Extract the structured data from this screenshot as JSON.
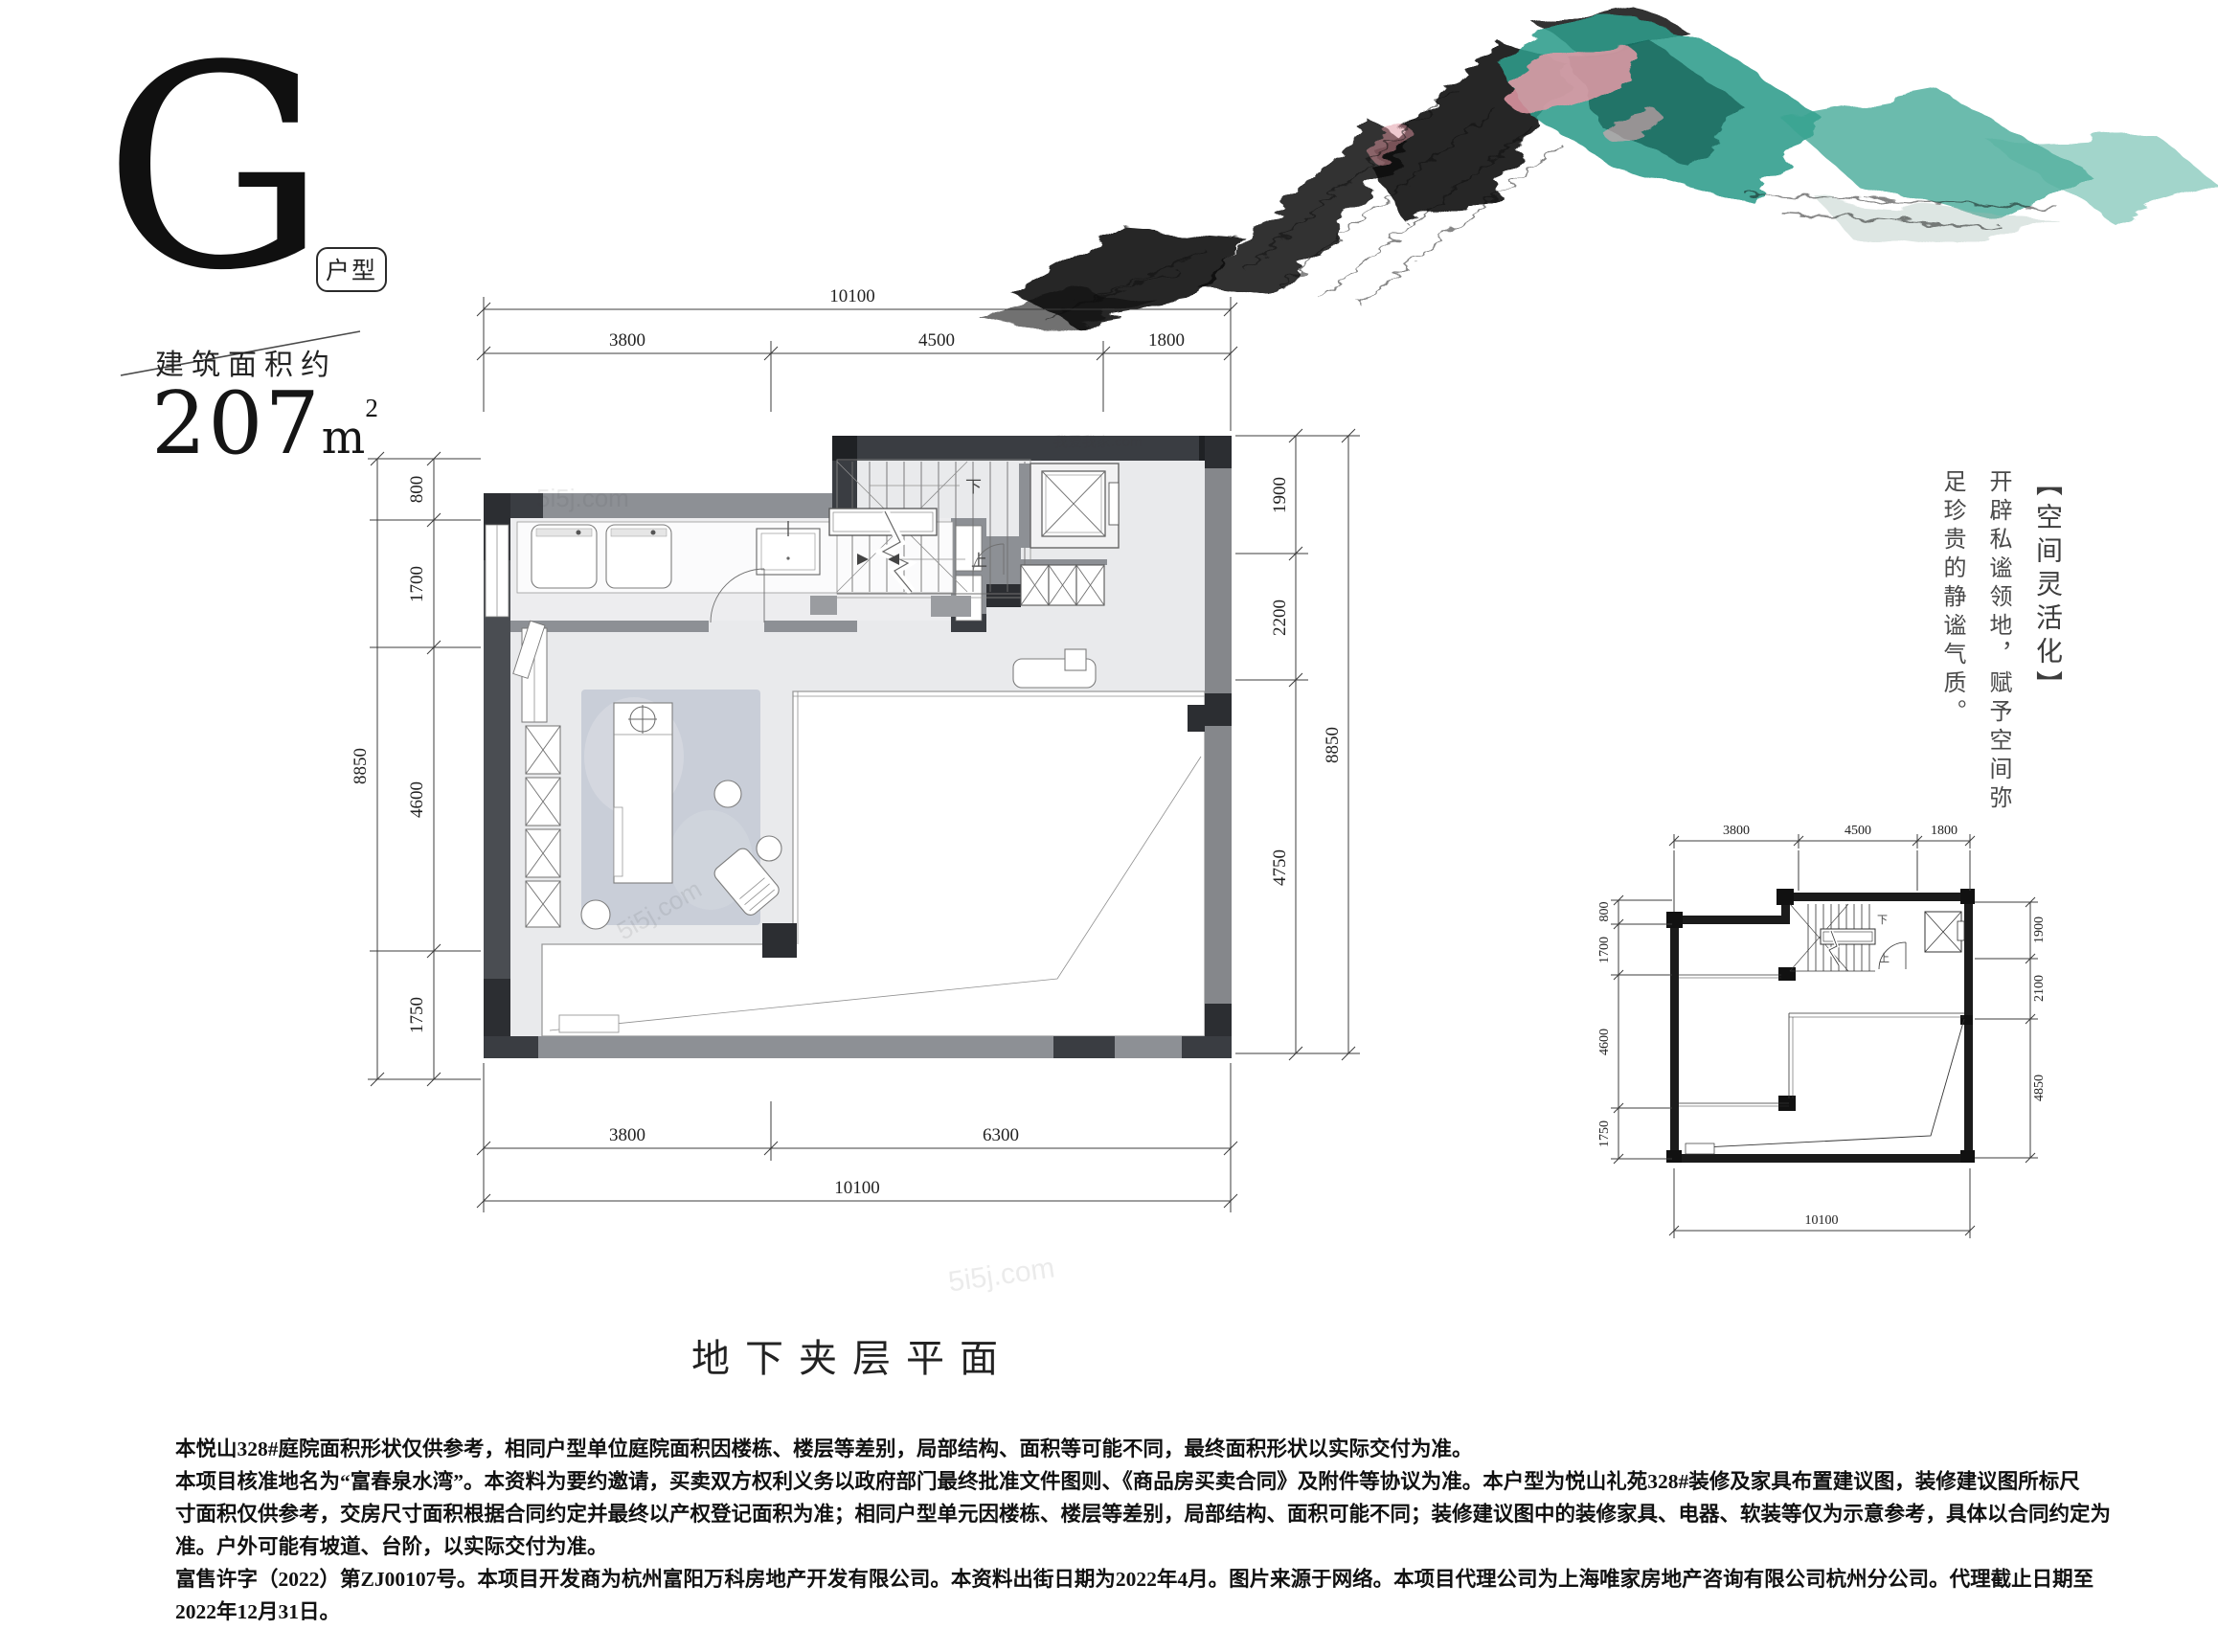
{
  "header": {
    "type_letter": "G",
    "type_badge": "户型",
    "area_label": "建筑面积约",
    "area_value": "207",
    "area_unit": "m",
    "area_sup": "2"
  },
  "main_plan": {
    "dims": {
      "top": {
        "total": "10100",
        "segments": [
          "3800",
          "4500",
          "1800"
        ]
      },
      "left": {
        "total": "8850",
        "segments": [
          "800",
          "1700",
          "4600",
          "1750"
        ]
      },
      "right": {
        "total": "8850",
        "segments": [
          "1900",
          "2200",
          "4750"
        ]
      },
      "bottom": {
        "total": "10100",
        "segments": [
          "3800",
          "6300"
        ]
      }
    },
    "stair_labels": {
      "down": "下",
      "up": "上"
    }
  },
  "mini_plan": {
    "dims": {
      "top": {
        "segments": [
          "3800",
          "4500",
          "1800"
        ]
      },
      "left": {
        "segments": [
          "800",
          "1700",
          "4600",
          "1750"
        ]
      },
      "right": {
        "segments": [
          "1900",
          "2100",
          "4850"
        ]
      },
      "bottom": {
        "total": "10100"
      }
    },
    "stair_labels": {
      "down": "下",
      "up": "上"
    }
  },
  "side_note": {
    "title": "【空间灵活化】",
    "line1": "开辟私谧领地，赋予空间弥",
    "line2": "足珍贵的静谧气质。"
  },
  "plan_title": "地下夹层平面",
  "watermarks": {
    "primary": "5i5j.com",
    "secondary": "我爱我家.com"
  },
  "artwork_colors": {
    "ink": "#0d0d0d",
    "teal": "#2f9c8b",
    "teal_dark": "#15685c",
    "pink": "#e59aa7"
  },
  "disclaimer": {
    "lines": [
      "本悦山328#庭院面积形状仅供参考，相同户型单位庭院面积因楼栋、楼层等差别，局部结构、面积等可能不同，最终面积形状以实际交付为准。",
      "本项目核准地名为“富春泉水湾”。本资料为要约邀请，买卖双方权利义务以政府部门最终批准文件图则、《商品房买卖合同》及附件等协议为准。本户型为悦山礼苑328#装修及家具布置建议图，装修建议图所标尺",
      "寸面积仅供参考，交房尺寸面积根据合同约定并最终以产权登记面积为准；相同户型单元因楼栋、楼层等差别，局部结构、面积可能不同；装修建议图中的装修家具、电器、软装等仅为示意参考，具体以合同约定为",
      "准。户外可能有坡道、台阶，以实际交付为准。",
      "富售许字（2022）第ZJ00107号。本项目开发商为杭州富阳万科房地产开发有限公司。本资料出街日期为2022年4月。图片来源于网络。本项目代理公司为上海唯家房地产咨询有限公司杭州分公司。代理截止日期至",
      "2022年12月31日。"
    ]
  }
}
